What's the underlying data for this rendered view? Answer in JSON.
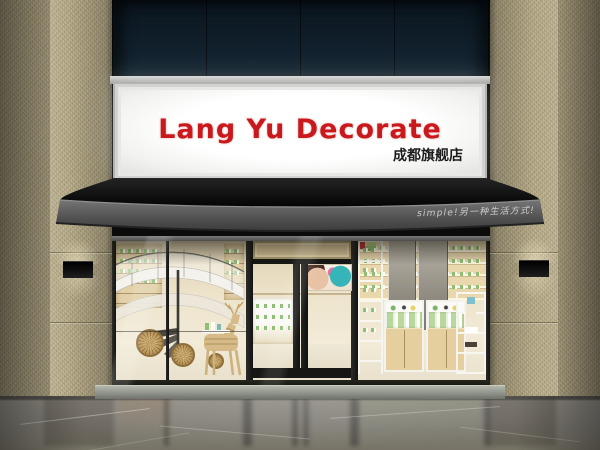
{
  "signboard": {
    "title": "Lang Yu Decorate",
    "subtitle": "成都旗舰店",
    "title_color": "#c9191c",
    "subtitle_color": "#1c1c1c",
    "panel_color": "#fbfbf9",
    "frame_color": "#cfcfcd"
  },
  "awning": {
    "slogan": "simple!另一种生活方式!",
    "slogan_color": "#d9d9d6",
    "canopy_color": "#0c0c0c",
    "fascia_color": "#5b5b5b"
  },
  "facade": {
    "upper_panel_color": "#0f1e29",
    "granite_color": "#b6ab88",
    "sconce_color": "#121212"
  },
  "storefront": {
    "frame_color": "#1c1c1a",
    "interior_color": "#ecdfc3",
    "threshold_color": "#9aa093",
    "floor_color": "#868378"
  }
}
